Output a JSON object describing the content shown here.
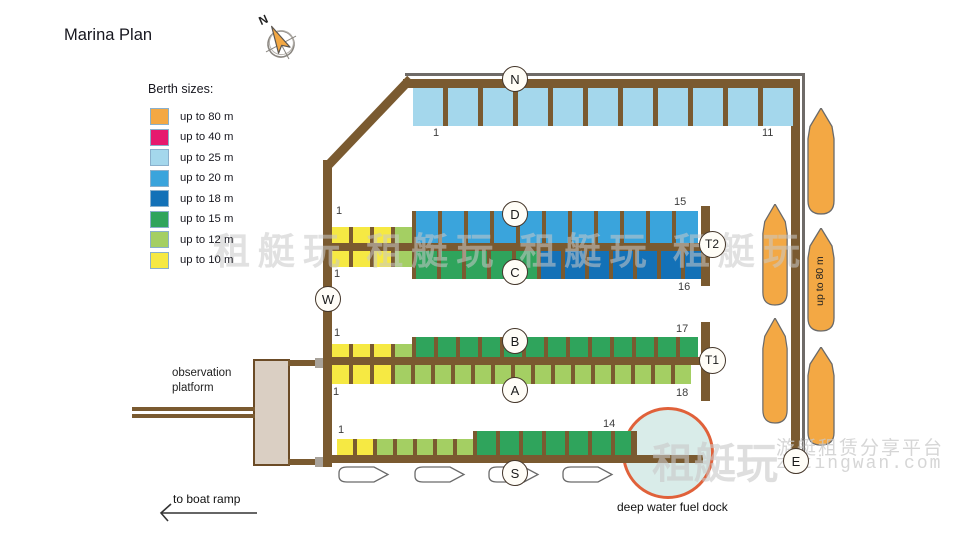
{
  "title": "Marina Plan",
  "compass": {
    "label": "N"
  },
  "legend": {
    "heading": "Berth sizes:",
    "items": [
      {
        "label": "up to 80 m",
        "color": "#f3a844"
      },
      {
        "label": "up to 40 m",
        "color": "#e6196e"
      },
      {
        "label": "up to 25 m",
        "color": "#a4d7ec"
      },
      {
        "label": "up to 20 m",
        "color": "#3aa4dc"
      },
      {
        "label": "up to 18 m",
        "color": "#1371b7"
      },
      {
        "label": "up to 15 m",
        "color": "#2fa45c"
      },
      {
        "label": "up to 12 m",
        "color": "#a4cf63"
      },
      {
        "label": "up to 10 m",
        "color": "#f6e943"
      }
    ]
  },
  "palette": {
    "y10": "#f6e943",
    "g12": "#a4cf63",
    "g15": "#2fa45c",
    "b18": "#1371b7",
    "b20": "#3aa4dc",
    "b25": "#a4d7ec",
    "o80": "#f3a844"
  },
  "docks": {
    "north": {
      "label": "N",
      "first_berth": "1",
      "last_berth": "11",
      "segments": [
        {
          "size": "b25",
          "count": 11
        }
      ]
    },
    "pier_dc": {
      "t_label": "T2",
      "upper": {
        "label": "D",
        "first": "1",
        "last": "15",
        "segments": [
          {
            "size": "y10",
            "count": 3
          },
          {
            "size": "g12",
            "count": 1
          },
          {
            "size": "b20",
            "count": 11
          }
        ]
      },
      "lower": {
        "label": "C",
        "first": "1",
        "last": "16",
        "segments": [
          {
            "size": "y10",
            "count": 3
          },
          {
            "size": "g12",
            "count": 1
          },
          {
            "size": "g15",
            "count": 5
          },
          {
            "size": "b18",
            "count": 7
          }
        ]
      }
    },
    "pier_ba": {
      "t_label": "T1",
      "upper": {
        "label": "B",
        "first": "1",
        "last": "17",
        "segments": [
          {
            "size": "y10",
            "count": 3
          },
          {
            "size": "g12",
            "count": 1
          },
          {
            "size": "g15",
            "count": 13
          }
        ]
      },
      "lower": {
        "label": "A",
        "first": "1",
        "last": "18",
        "segments": [
          {
            "size": "y10",
            "count": 3
          },
          {
            "size": "g12",
            "count": 15
          }
        ]
      }
    },
    "south": {
      "label": "S",
      "first_berth": "1",
      "last_berth": "14",
      "segments": [
        {
          "size": "y10",
          "count": 2
        },
        {
          "size": "g12",
          "count": 5
        },
        {
          "size": "g15",
          "count": 7
        }
      ]
    },
    "west": {
      "label": "W"
    },
    "east": {
      "label": "E",
      "berth_note": "up to 80 m"
    }
  },
  "annotations": {
    "observation_platform": "observation platform",
    "boat_ramp": "to boat ramp",
    "fuel_dock": "deep water fuel dock"
  },
  "watermark": {
    "repeat_text": "租艇玩    租艇玩    租艇玩    租艇玩",
    "brand": "租艇玩",
    "tagline": "游艇租赁分享平台",
    "site": "zutingwan.com"
  }
}
